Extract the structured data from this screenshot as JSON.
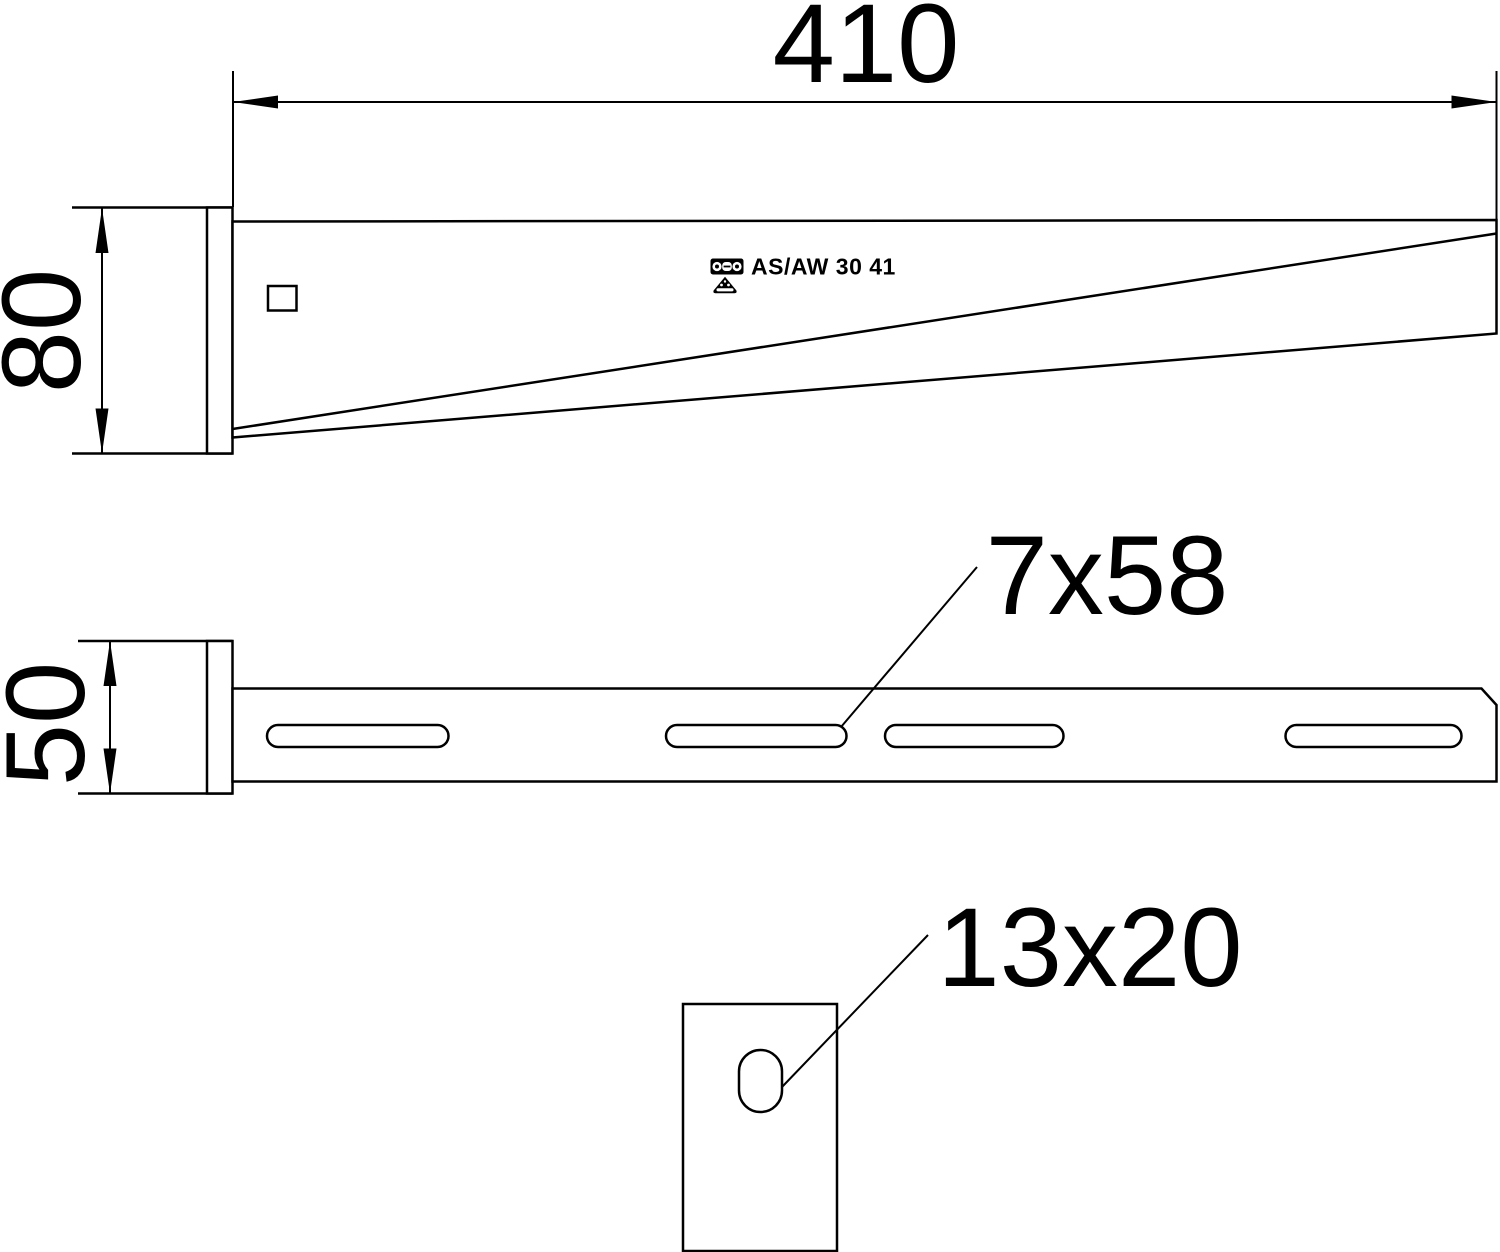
{
  "drawing": {
    "product_label": "AS/AW 30 41",
    "side_view": {
      "length_dim": "410",
      "height_dim": "80"
    },
    "plan_view": {
      "width_dim": "50",
      "slot_callout": "7x58"
    },
    "end_plate_view": {
      "hole_callout": "13x20"
    }
  },
  "icons": {
    "logo": "obo-logo-icon",
    "triangle": "certification-triangle-icon"
  },
  "colors": {
    "line": "#000000",
    "background": "#ffffff"
  }
}
